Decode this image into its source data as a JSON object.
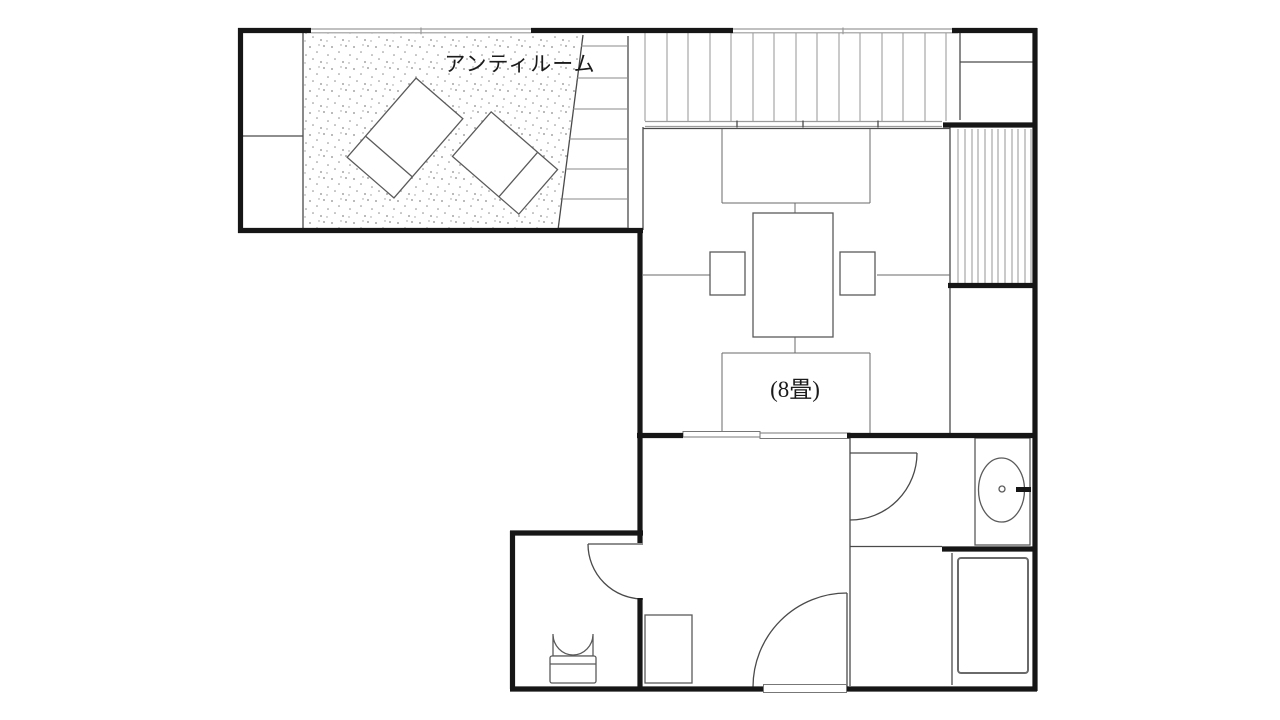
{
  "floor_plan": {
    "anteroom_label": "アンティルーム",
    "tatami_room_label": "(8畳)",
    "text_color": "#1b1b1b",
    "colors": {
      "wall": "#161616",
      "partition": "#4a4a4a",
      "light_line": "#9a9a9a",
      "background": "#ffffff"
    }
  }
}
